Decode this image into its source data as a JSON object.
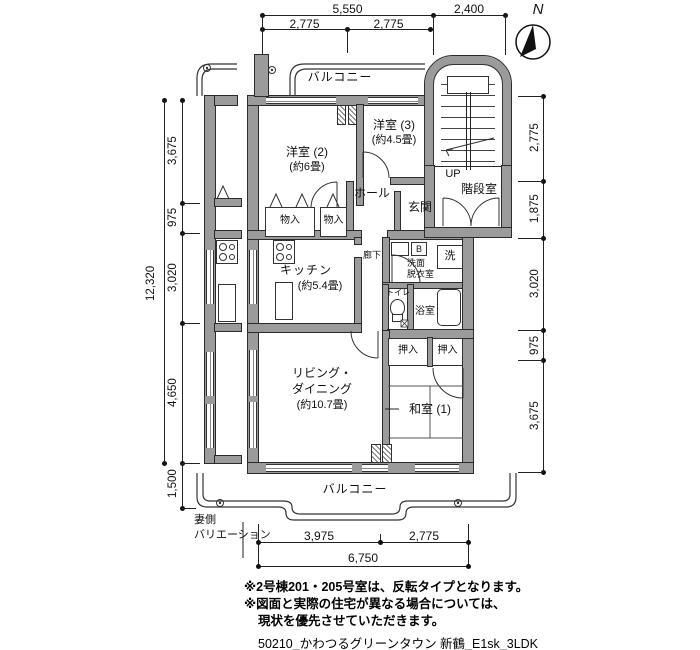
{
  "compass": {
    "n": "N"
  },
  "dims": {
    "top": {
      "total": "5,550",
      "half_a": "2,775",
      "half_b": "2,775",
      "stair": "2,400"
    },
    "left": {
      "total": "12,320",
      "segs": [
        "3,675",
        "975",
        "3,020",
        "4,650",
        "1,500"
      ]
    },
    "right": {
      "segs": [
        "2,775",
        "1,875",
        "3,020",
        "975",
        "3,675"
      ]
    },
    "bottom": {
      "segs": [
        "3,975",
        "2,775"
      ],
      "total": "6,750"
    }
  },
  "rooms": {
    "balcony_top": "バルコニー",
    "bed2": "洋室 (2)",
    "bed2_size": "(約6畳)",
    "bed3": "洋室 (3)",
    "bed3_size": "(約4.5畳)",
    "hall": "ホール",
    "entrance": "玄関",
    "up": "UP",
    "stairwell": "階段室",
    "closet_a": "物入",
    "closet_b": "物入",
    "kitchen": "キッチン",
    "kitchen_size": "(約5.4畳)",
    "corridor": "廊下",
    "washroom_l1": "洗面",
    "washroom_l2": "脱衣室",
    "boiler": "B",
    "laundry": "洗",
    "toilet": "トイレ",
    "bath": "浴室",
    "oshiire_a": "押入",
    "oshiire_b": "押入",
    "living_l1": "リビング・",
    "living_l2": "ダイニング",
    "living_size": "(約10.7畳)",
    "washitsu": "和室 (1)",
    "balcony_bottom": "バルコニー"
  },
  "annotations": {
    "gable_l1": "妻側",
    "gable_l2": "バリエーション"
  },
  "notes": {
    "line1": "※2号棟201・205号室は、反転タイプとなります。",
    "line2": "※図面と実際の住宅が異なる場合については、",
    "line3": "現状を優先させていただきます。"
  },
  "caption": "50210_かわつるグリーンタウン 新鶴_E1sk_3LDK"
}
